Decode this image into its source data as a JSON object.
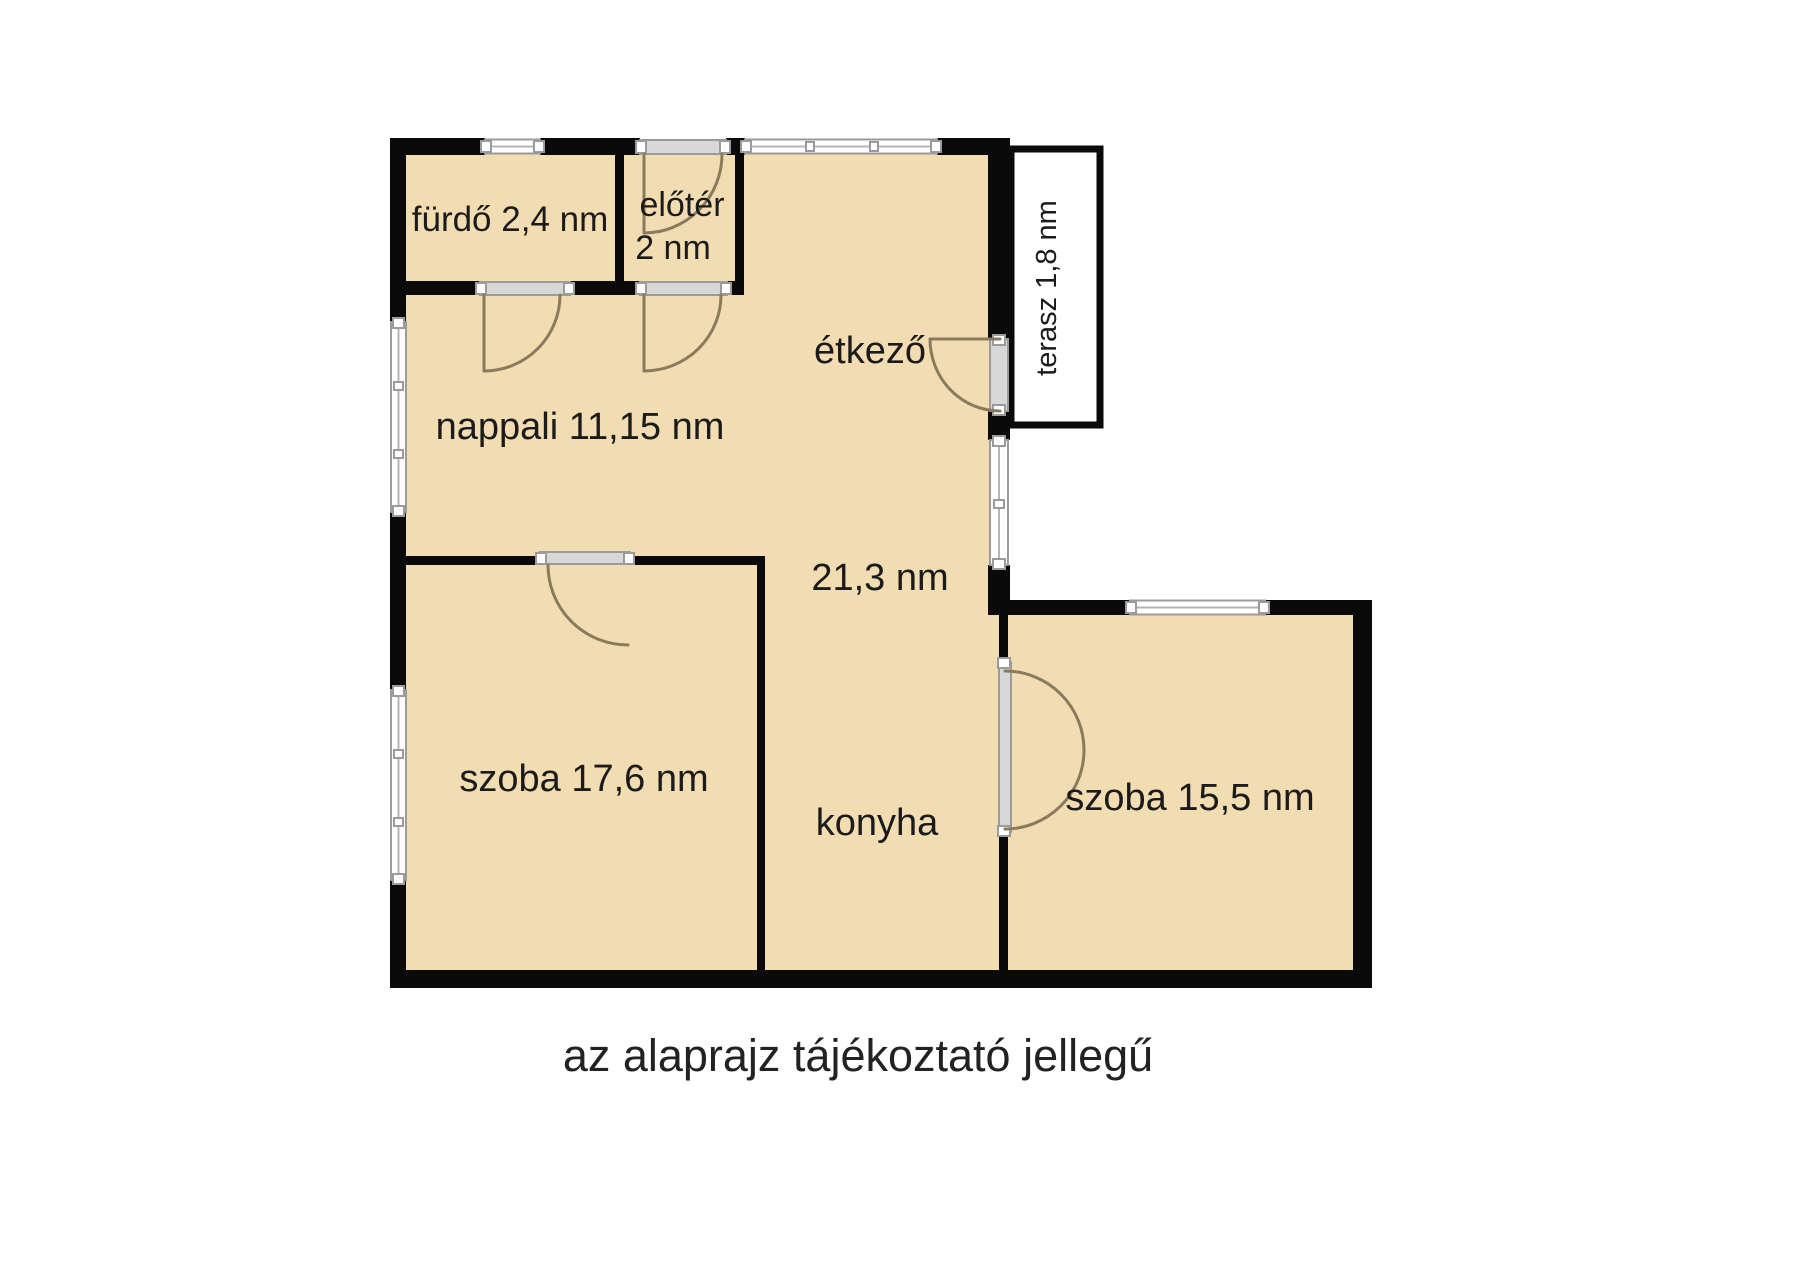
{
  "plan": {
    "rooms": [
      {
        "id": "furdo",
        "label": "fürdő 2,4 nm"
      },
      {
        "id": "eloter",
        "label_line1": "előtér",
        "label_line2": "2 nm"
      },
      {
        "id": "terasz",
        "label": "terasz 1,8 nm"
      },
      {
        "id": "nappali",
        "label": "nappali 11,15 nm"
      },
      {
        "id": "etkezo",
        "label": "étkező"
      },
      {
        "id": "etkezo_konyha_area",
        "label": "21,3 nm"
      },
      {
        "id": "szoba_nagy",
        "label": "szoba 17,6 nm"
      },
      {
        "id": "konyha",
        "label": "konyha"
      },
      {
        "id": "szoba_kis",
        "label": "szoba 15,5 nm"
      }
    ],
    "caption": "az alaprajz tájékoztató jellegű",
    "colors": {
      "background": "#ffffff",
      "floor": "#f2dcb2",
      "wall": "#0a0a0a",
      "window_fill": "#ffffff",
      "window_frame": "#9b9b9b",
      "threshold_fill": "#d8d8d8",
      "door_arc": "#8b7b5e",
      "terrace_fill": "#ffffff",
      "text": "#1b1b1b"
    }
  }
}
